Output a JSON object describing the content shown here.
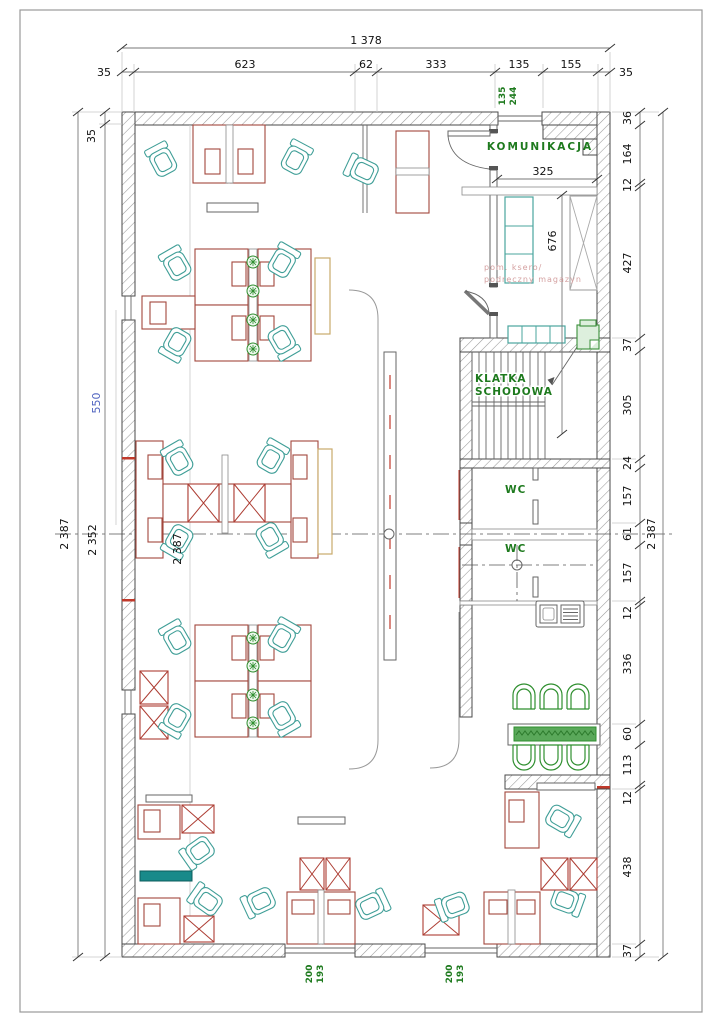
{
  "colors": {
    "label_green": "#1e7a1e",
    "furniture_red": "#a3463c",
    "cabinet_red": "#ad3d33",
    "chair_teal": "#3f9e97",
    "plant_green": "#2f8f2f",
    "dim_blue": "#4f63c0",
    "note_pink": "#d4a0a0",
    "teal_fill": "#188a8a",
    "cabinet_tan": "#c9a96a"
  },
  "dims": {
    "top_total": "1 378",
    "top_chain": [
      "35",
      "623",
      "62",
      "333",
      "135",
      "155",
      "35"
    ],
    "right_chain": [
      "36",
      "164",
      "12",
      "427",
      "37",
      "305",
      "24",
      "157",
      "61",
      "157",
      "12",
      "336",
      "60",
      "113",
      "12",
      "438",
      "37"
    ],
    "right_total": "2 387",
    "left_outer_total": "2 387",
    "left_inner_total": "2 352",
    "wall_top_left": "35",
    "blue_width": "550",
    "inner_height": "2 387",
    "komunikacja_width": "325",
    "storage_depth": "676",
    "door_dim_a": "135",
    "door_dim_b": "244",
    "window1_a": "200",
    "window1_b": "193",
    "window2_a": "200",
    "window2_b": "193"
  },
  "labels": {
    "komunikacja": "KOMUNIKACJA",
    "stairwell_line1": "KLATKA",
    "stairwell_line2": "SCHODOWA",
    "wc_upper": "WC",
    "wc_lower": "WC",
    "storage_note_line1": "pom. ksero/",
    "storage_note_line2": "podręczny magazyn"
  }
}
